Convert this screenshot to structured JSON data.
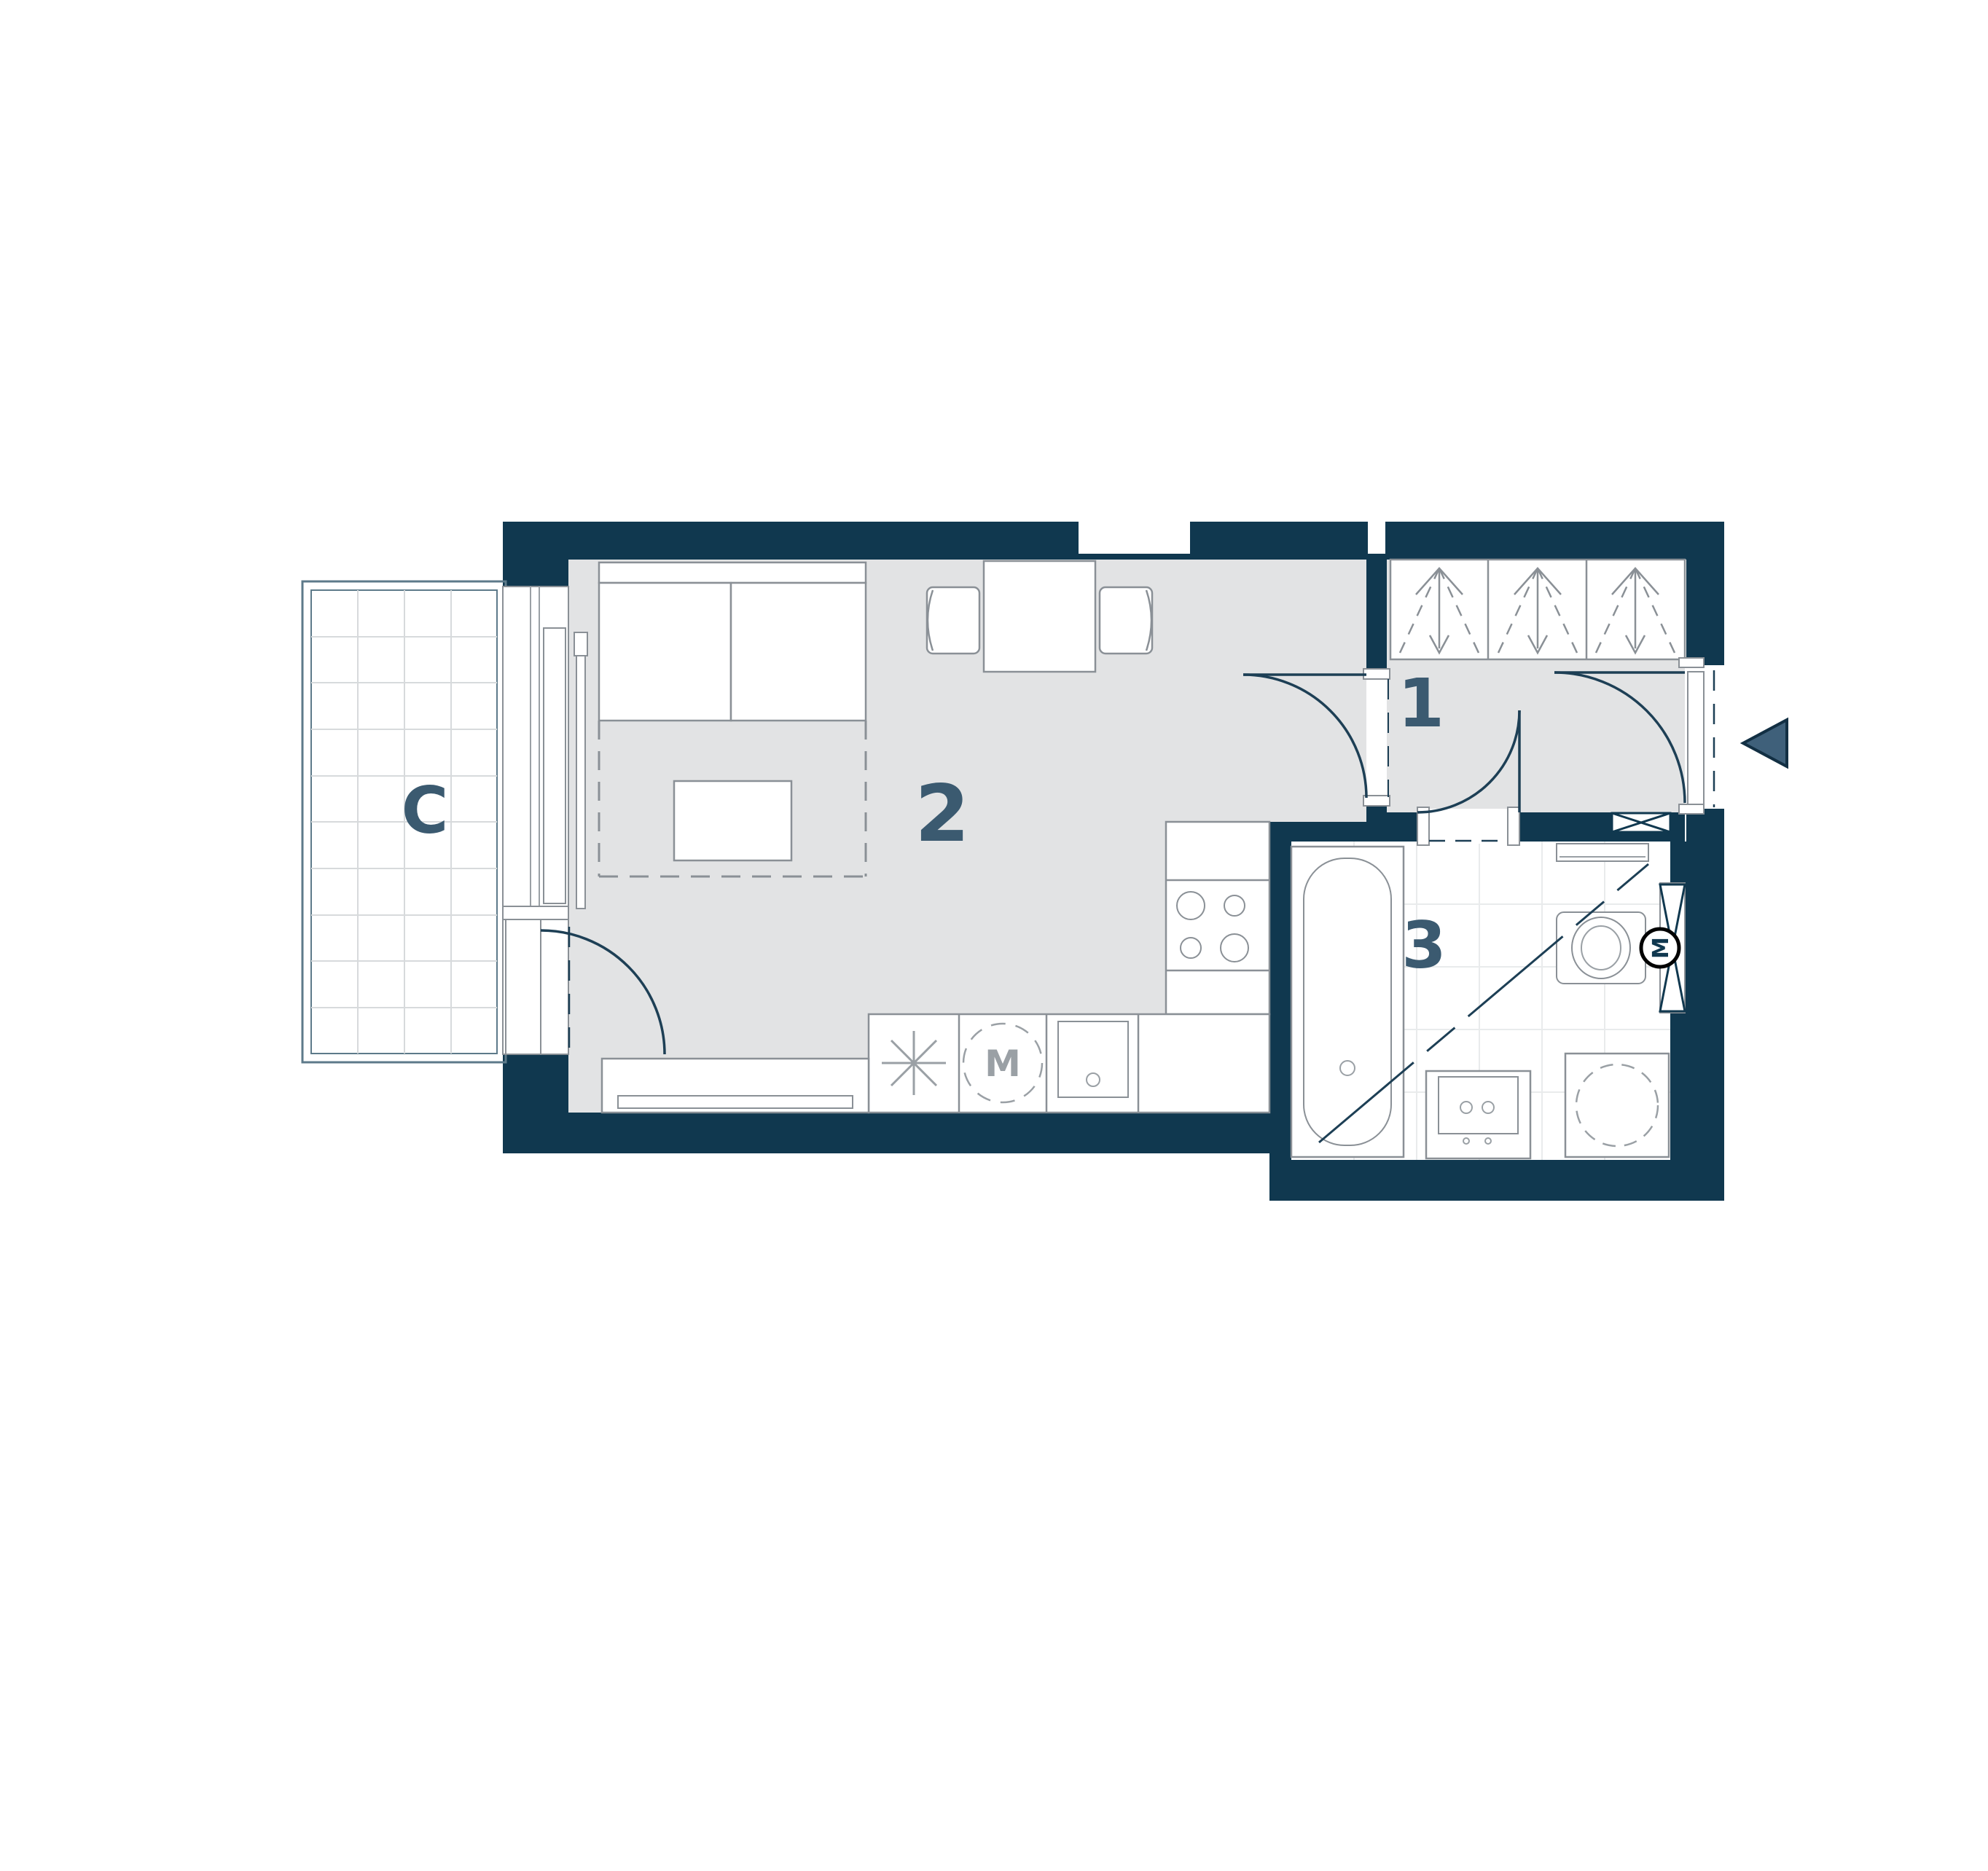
{
  "plan": {
    "type": "apartment-floor-plan",
    "rooms": {
      "balcony": {
        "label": "C"
      },
      "entrance_hall": {
        "label": "1"
      },
      "living_kitchen": {
        "label": "2"
      },
      "bathroom": {
        "label": "3"
      }
    },
    "symbols": {
      "washing_machine_label": "M",
      "fan_motor_label": "M"
    },
    "colors": {
      "wall": "#10384f",
      "floor": "#e2e3e4",
      "furniture_line": "#8a9096",
      "door_line": "#1d3f55",
      "room_label": "#3b5a70",
      "entrance_arrow": "#3f607a",
      "balcony_frame": "#5d7a8a"
    }
  }
}
